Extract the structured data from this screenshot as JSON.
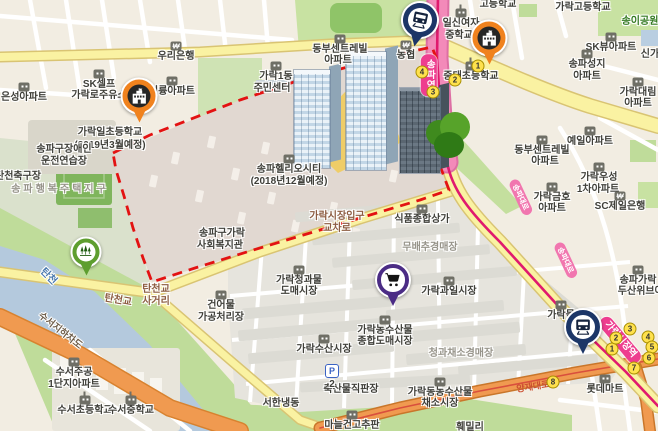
{
  "map": {
    "style": "korean-web-map",
    "region_hint": "가락동 · 송파 일대 지도 (송파헬리오시티 재건축 구역 표시)",
    "colors": {
      "background": "#F2EDE2",
      "water": "#B4C9DD",
      "park_green": "#C8E2A2",
      "road_yellow": "#FAF2A2",
      "road_orange": "#F09A50",
      "subway_line_pink": "#E01A6E",
      "boundary_red": "#E31212",
      "marker_navy": "#1C3667",
      "marker_orange": "#F0821E",
      "marker_green": "#5E9E2F",
      "marker_purple": "#4B2C85",
      "station_pink": "#EE3D8F"
    },
    "markers": [
      {
        "name": "subway-marker-songpa",
        "icon": "train",
        "color": "navy",
        "x": 420,
        "y": 20,
        "size": 34,
        "rot": 12
      },
      {
        "name": "subway-marker-garak-market",
        "icon": "train",
        "color": "navy",
        "x": 583,
        "y": 327,
        "size": 34
      },
      {
        "name": "school-marker-garakil",
        "icon": "school",
        "color": "orange",
        "x": 139,
        "y": 96,
        "size": 33
      },
      {
        "name": "school-marker-ilsin",
        "icon": "school",
        "color": "orange",
        "x": 489,
        "y": 38,
        "size": 33
      },
      {
        "name": "park-marker-tancheon",
        "icon": "trees",
        "color": "green",
        "x": 86,
        "y": 252,
        "size": 27
      },
      {
        "name": "market-marker-garak",
        "icon": "cart",
        "color": "purple",
        "x": 393,
        "y": 280,
        "size": 32
      }
    ],
    "stations": [
      {
        "label": "송파역",
        "x": 429,
        "y": 75,
        "vertical": true
      },
      {
        "label": "가락시장역",
        "x": 620,
        "y": 340,
        "rot": 50
      }
    ],
    "road_pills": [
      {
        "label": "송파대로",
        "x": 521,
        "y": 197,
        "rot": 65
      },
      {
        "label": "송파대로",
        "x": 566,
        "y": 260,
        "rot": 65
      }
    ],
    "exit_badges": [
      {
        "station": "송파역",
        "n": "1",
        "x": 478,
        "y": 66
      },
      {
        "station": "송파역",
        "n": "2",
        "x": 455,
        "y": 80
      },
      {
        "station": "송파역",
        "n": "3",
        "x": 433,
        "y": 92
      },
      {
        "station": "송파역",
        "n": "4",
        "x": 422,
        "y": 72
      },
      {
        "station": "가락시장역",
        "n": "1",
        "x": 612,
        "y": 349
      },
      {
        "station": "가락시장역",
        "n": "2",
        "x": 616,
        "y": 338
      },
      {
        "station": "가락시장역",
        "n": "3",
        "x": 630,
        "y": 329
      },
      {
        "station": "가락시장역",
        "n": "4",
        "x": 648,
        "y": 337
      },
      {
        "station": "가락시장역",
        "n": "5",
        "x": 652,
        "y": 347
      },
      {
        "station": "가락시장역",
        "n": "6",
        "x": 649,
        "y": 358
      },
      {
        "station": "가락시장역",
        "n": "7",
        "x": 634,
        "y": 368
      },
      {
        "station": "가락시장역",
        "n": "8",
        "x": 553,
        "y": 382
      }
    ],
    "parking": {
      "label": "P",
      "number": "2",
      "x": 332,
      "y": 371
    },
    "labels": [
      {
        "t": "은성아파트",
        "x": 24,
        "y": 98,
        "icon": "bldg"
      },
      {
        "t": "SK셀프",
        "x": 99,
        "y": 85,
        "icon": "gas"
      },
      {
        "t": "가락로주유소",
        "x": 99,
        "y": 96
      },
      {
        "t": "우리은행",
        "x": 176,
        "y": 57,
        "icon": "bank"
      },
      {
        "t": "가락일초등학교",
        "x": 110,
        "y": 133
      },
      {
        "t": "(2019년3월예정)",
        "x": 110,
        "y": 146
      },
      {
        "t": "미륭아파트",
        "x": 172,
        "y": 92,
        "icon": "bldg"
      },
      {
        "t": "송파구장애인",
        "x": 64,
        "y": 150
      },
      {
        "t": "운전연습장",
        "x": 64,
        "y": 162
      },
      {
        "t": "탄천축구장",
        "x": 18,
        "y": 177
      },
      {
        "t": "송파행복주택지구",
        "x": 60,
        "y": 190,
        "c": "area",
        "ls": 3
      },
      {
        "t": "탄천",
        "x": 48,
        "y": 277,
        "c": "water",
        "rot": 45
      },
      {
        "t": "탄천교",
        "x": 118,
        "y": 301,
        "c": "inter",
        "rot": 10
      },
      {
        "t": "탄천교",
        "x": 156,
        "y": 290,
        "c": "inter"
      },
      {
        "t": "사거리",
        "x": 156,
        "y": 302,
        "c": "inter"
      },
      {
        "t": "수서지하차도",
        "x": 60,
        "y": 331,
        "c": "road",
        "rot": 38
      },
      {
        "t": "수서주공",
        "x": 74,
        "y": 373,
        "icon": "bldg"
      },
      {
        "t": "1단지아파트",
        "x": 74,
        "y": 385
      },
      {
        "t": "수서초등학교",
        "x": 85,
        "y": 411,
        "icon": "school"
      },
      {
        "t": "수서중학교",
        "x": 131,
        "y": 411,
        "icon": "school"
      },
      {
        "t": "건어물",
        "x": 221,
        "y": 306,
        "icon": "market"
      },
      {
        "t": "가공처리장",
        "x": 221,
        "y": 318
      },
      {
        "t": "동부센트레빌",
        "x": 340,
        "y": 50,
        "icon": "bldg"
      },
      {
        "t": "아파트",
        "x": 338,
        "y": 61
      },
      {
        "t": "가락1동",
        "x": 276,
        "y": 77,
        "icon": "bldg"
      },
      {
        "t": "주민센터",
        "x": 272,
        "y": 89
      },
      {
        "t": "농협",
        "x": 406,
        "y": 56,
        "icon": "bank"
      },
      {
        "t": "송파헬리오시티",
        "x": 289,
        "y": 170,
        "icon": "bldg"
      },
      {
        "t": "(2018년12월예정)",
        "x": 289,
        "y": 182
      },
      {
        "t": "송파구가락",
        "x": 222,
        "y": 234
      },
      {
        "t": "사회복지관",
        "x": 220,
        "y": 246
      },
      {
        "t": "가락시장입구",
        "x": 337,
        "y": 217,
        "c": "inter"
      },
      {
        "t": "교차로",
        "x": 337,
        "y": 229,
        "c": "inter"
      },
      {
        "t": "식품종합상가",
        "x": 422,
        "y": 220,
        "icon": "market"
      },
      {
        "t": "무배추경매장",
        "x": 430,
        "y": 248,
        "c": "area"
      },
      {
        "t": "가락청과물",
        "x": 299,
        "y": 281,
        "icon": "market"
      },
      {
        "t": "도매시장",
        "x": 299,
        "y": 292
      },
      {
        "t": "가락과일시장",
        "x": 449,
        "y": 292,
        "icon": "market"
      },
      {
        "t": "가락농수산물",
        "x": 385,
        "y": 331,
        "icon": "market"
      },
      {
        "t": "종합도매시장",
        "x": 385,
        "y": 342
      },
      {
        "t": "가락수산시장",
        "x": 324,
        "y": 350,
        "icon": "market"
      },
      {
        "t": "청과채소경매장",
        "x": 461,
        "y": 354,
        "c": "area"
      },
      {
        "t": "축산물직판장",
        "x": 351,
        "y": 390
      },
      {
        "t": "서한냉동",
        "x": 281,
        "y": 404
      },
      {
        "t": "2",
        "x": 332,
        "y": 385
      },
      {
        "t": "마늘건고추판",
        "x": 352,
        "y": 426,
        "icon": "market"
      },
      {
        "t": "가락동농수산물",
        "x": 440,
        "y": 393,
        "icon": "market"
      },
      {
        "t": "채소시장",
        "x": 440,
        "y": 404
      },
      {
        "t": "롯데마트",
        "x": 605,
        "y": 390,
        "icon": "market"
      },
      {
        "t": "훼밀리",
        "x": 470,
        "y": 428
      },
      {
        "t": "고등학교",
        "x": 498,
        "y": 5
      },
      {
        "t": "가락고등학교",
        "x": 583,
        "y": 8
      },
      {
        "t": "일신여자",
        "x": 461,
        "y": 24,
        "icon": "school"
      },
      {
        "t": "중학교",
        "x": 459,
        "y": 36
      },
      {
        "t": "중대초등학교",
        "x": 471,
        "y": 77,
        "icon": "school"
      },
      {
        "t": "송이공원",
        "x": 640,
        "y": 22,
        "c": "park"
      },
      {
        "t": "SK뷰아파트",
        "x": 611,
        "y": 48,
        "icon": "bldg"
      },
      {
        "t": "신가",
        "x": 650,
        "y": 55
      },
      {
        "t": "송파성지",
        "x": 587,
        "y": 65,
        "icon": "bldg"
      },
      {
        "t": "아파트",
        "x": 587,
        "y": 77
      },
      {
        "t": "가락대림",
        "x": 638,
        "y": 93,
        "icon": "bldg"
      },
      {
        "t": "아파트",
        "x": 638,
        "y": 104
      },
      {
        "t": "예일아파트",
        "x": 590,
        "y": 142,
        "icon": "bldg"
      },
      {
        "t": "동부센트레빌",
        "x": 542,
        "y": 151,
        "icon": "bldg"
      },
      {
        "t": "아파트",
        "x": 545,
        "y": 162
      },
      {
        "t": "가락우성",
        "x": 599,
        "y": 178,
        "icon": "bldg"
      },
      {
        "t": "1차아파트",
        "x": 598,
        "y": 190
      },
      {
        "t": "가락금호",
        "x": 552,
        "y": 198,
        "icon": "bldg"
      },
      {
        "t": "아파트",
        "x": 552,
        "y": 209
      },
      {
        "t": "SC제일은행",
        "x": 620,
        "y": 207,
        "icon": "bank"
      },
      {
        "t": "송파가락",
        "x": 638,
        "y": 281,
        "icon": "bldg"
      },
      {
        "t": "두산위브아파트",
        "x": 650,
        "y": 292
      },
      {
        "t": "가락몰",
        "x": 561,
        "y": 316,
        "icon": "bldg"
      },
      {
        "t": "양재대로",
        "x": 533,
        "y": 387,
        "c": "redroad",
        "rot": -9
      }
    ]
  }
}
